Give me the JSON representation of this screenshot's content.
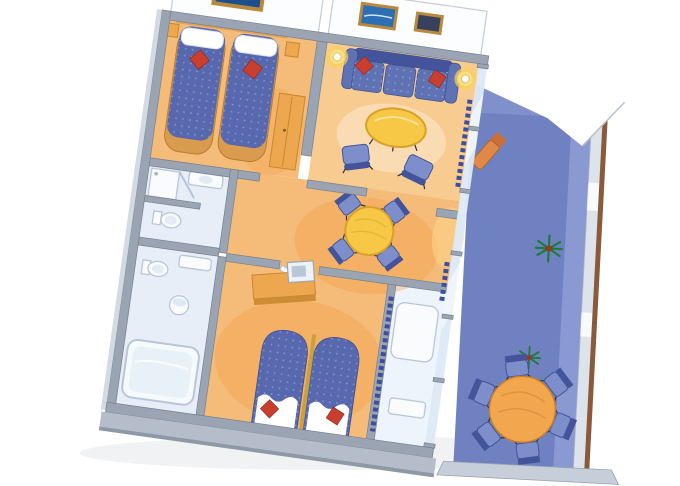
{
  "scene": {
    "kind": "cutaway-floor-plan-illustration",
    "subject": "two-bedroom-suite-with-private-balcony",
    "background": "#ffffff"
  },
  "palette": {
    "wall_top": "#9aa4b2",
    "wall_edge": "#76818f",
    "wall_face": "#b4bdc9",
    "wall_light": "#d3dae2",
    "floor_warm": "#f4bb79",
    "floor_glow": "#f59b3c",
    "bath_floor": "#e8eef8",
    "balcony_deck": "#7081c2",
    "balcony_deck_light": "#93a2d6",
    "railing_wood": "#8a5a3b",
    "railing_face": "#dde3eb",
    "canopy_white": "#ffffff",
    "sofa_blue": "#5f72b4",
    "sofa_blue_dark": "#44549b",
    "chair_blue": "#7d8ecb",
    "bed_blue": "#5868ae",
    "cushion_red": "#c93f2f",
    "wood_orange": "#eda74f",
    "wood_orange_dark": "#c8882f",
    "table_yellow": "#f6c845",
    "table_yellow_edge": "#d8a22a",
    "balcony_table": "#f2a74e",
    "plant_green": "#1f7a3d",
    "plant_pot": "#a33226",
    "frame_gold": "#b98a3e",
    "picture_blue": "#2d6fb5",
    "picture_dark": "#39405c",
    "glass_blue": "#dde9f5",
    "curtain_blue": "#3d4f9e",
    "fixture_white": "#f9fbfd",
    "fixture_edge": "#b9c6d8"
  },
  "rooms": [
    {
      "id": "bedroom-1",
      "name": "twin-bedroom",
      "furniture": [
        "twin-bed",
        "twin-bed",
        "red-throw-pillow",
        "red-throw-pillow",
        "nightstand",
        "nightstand",
        "wardrobe",
        "framed-sailboat-picture"
      ]
    },
    {
      "id": "living-room",
      "name": "living-room",
      "furniture": [
        "sofa",
        "red-throw-pillow",
        "red-throw-pillow",
        "coffee-table",
        "armchair",
        "armchair",
        "table-lamp",
        "table-lamp",
        "framed-seascape-picture",
        "framed-dark-picture"
      ]
    },
    {
      "id": "dining-area",
      "name": "dining-area",
      "furniture": [
        "round-dining-table",
        "dining-chair",
        "dining-chair",
        "dining-chair",
        "dining-chair"
      ]
    },
    {
      "id": "bathroom-upper",
      "name": "shower-room",
      "furniture": [
        "shower",
        "sink-counter",
        "toilet"
      ]
    },
    {
      "id": "bathroom-lower",
      "name": "main-bathroom",
      "furniture": [
        "bathtub",
        "pedestal-sink",
        "toilet",
        "vanity-counter"
      ]
    },
    {
      "id": "bedroom-2",
      "name": "master-bedroom",
      "furniture": [
        "bed",
        "bed",
        "red-throw-pillow",
        "red-throw-pillow",
        "vanity-desk",
        "television",
        "door-leaf"
      ]
    },
    {
      "id": "master-bath",
      "name": "en-suite-bath",
      "furniture": [
        "vanity",
        "tub",
        "curtain"
      ]
    },
    {
      "id": "balcony",
      "name": "private-balcony",
      "furniture": [
        "round-patio-table",
        "patio-chair",
        "patio-chair",
        "patio-chair",
        "patio-chair",
        "patio-chair",
        "patio-chair",
        "lounge-chair",
        "potted-plant",
        "potted-plant",
        "railing",
        "canopy"
      ]
    }
  ]
}
